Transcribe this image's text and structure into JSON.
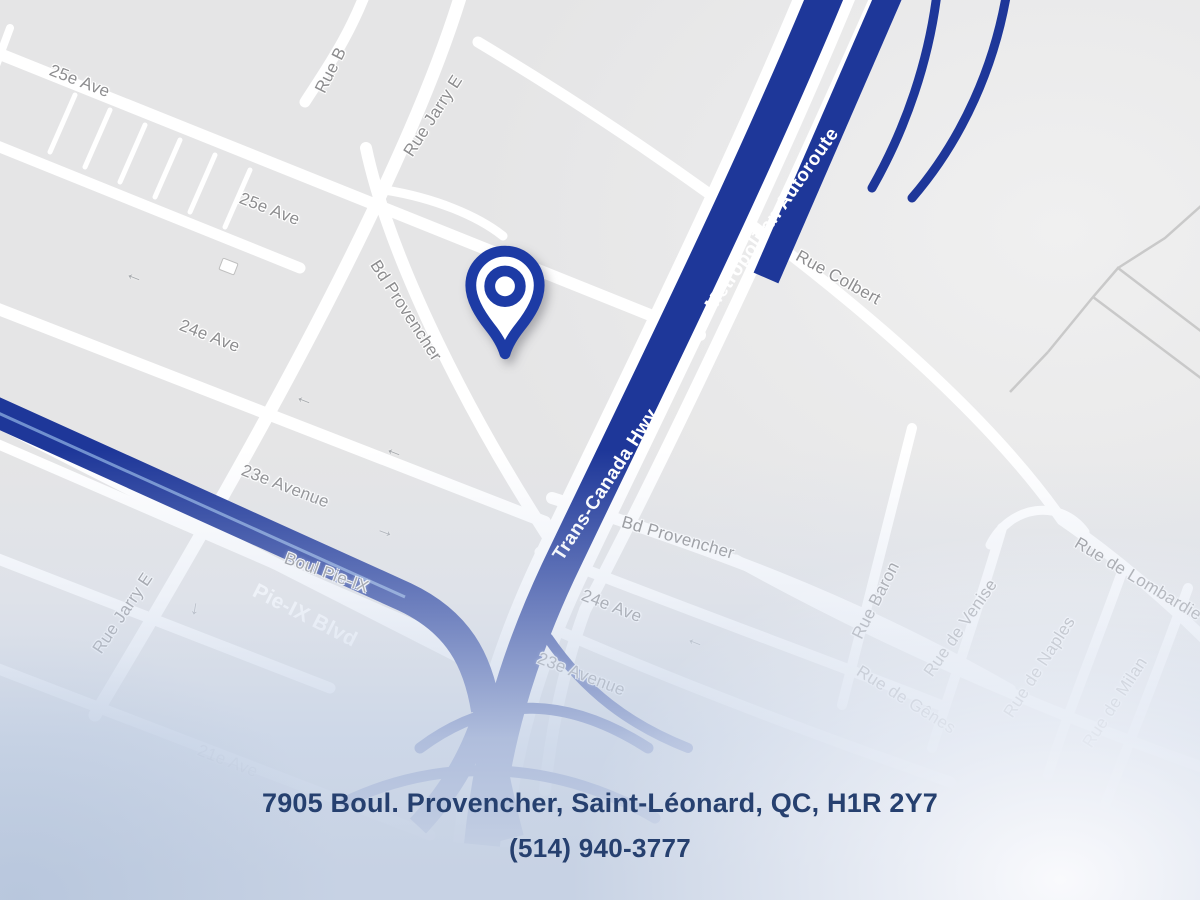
{
  "colors": {
    "highway_blue": "#1e3799",
    "pieix_streak": "#7fa0d8",
    "road_white": "#ffffff",
    "map_bg": "#e5e5e6",
    "label_gray": "#8d8d8f",
    "boundary_gray": "#c9c9c9",
    "pin_blue": "#1d3ba5",
    "footer_navy": "#26406f"
  },
  "map": {
    "street_labels": [
      {
        "text": "25e Ave"
      },
      {
        "text": "25e Ave"
      },
      {
        "text": "24e Ave"
      },
      {
        "text": "23e Avenue"
      },
      {
        "text": "Boul Pie-IX"
      },
      {
        "text": "21e Ave"
      },
      {
        "text": "Rue Jarry E"
      },
      {
        "text": "Rue B"
      },
      {
        "text": "Bd Provencher"
      },
      {
        "text": "Rue Colbert"
      },
      {
        "text": "Bd Provencher"
      },
      {
        "text": "24e Ave"
      },
      {
        "text": "23e Avenue"
      },
      {
        "text": "Rue Jarry E"
      },
      {
        "text": "Rue Baron"
      },
      {
        "text": "Rue de Venise"
      },
      {
        "text": "Rue de Naples"
      },
      {
        "text": "Rue de Lombardie"
      },
      {
        "text": "Rue de Gênes"
      },
      {
        "text": "Rue de Milan"
      }
    ],
    "highway_labels": [
      {
        "text": "Trans-Canada Hwy"
      },
      {
        "text": "Metropolitan Autoroute"
      },
      {
        "text": "Pie-IX Blvd"
      }
    ],
    "arrows": [
      {
        "glyph": "←"
      },
      {
        "glyph": "←"
      },
      {
        "glyph": "←"
      },
      {
        "glyph": "→"
      },
      {
        "glyph": "↓"
      },
      {
        "glyph": "←"
      }
    ]
  },
  "footer": {
    "address": "7905 Boul. Provencher, Saint-Léonard, QC, H1R 2Y7",
    "phone": "(514) 940-3777"
  }
}
